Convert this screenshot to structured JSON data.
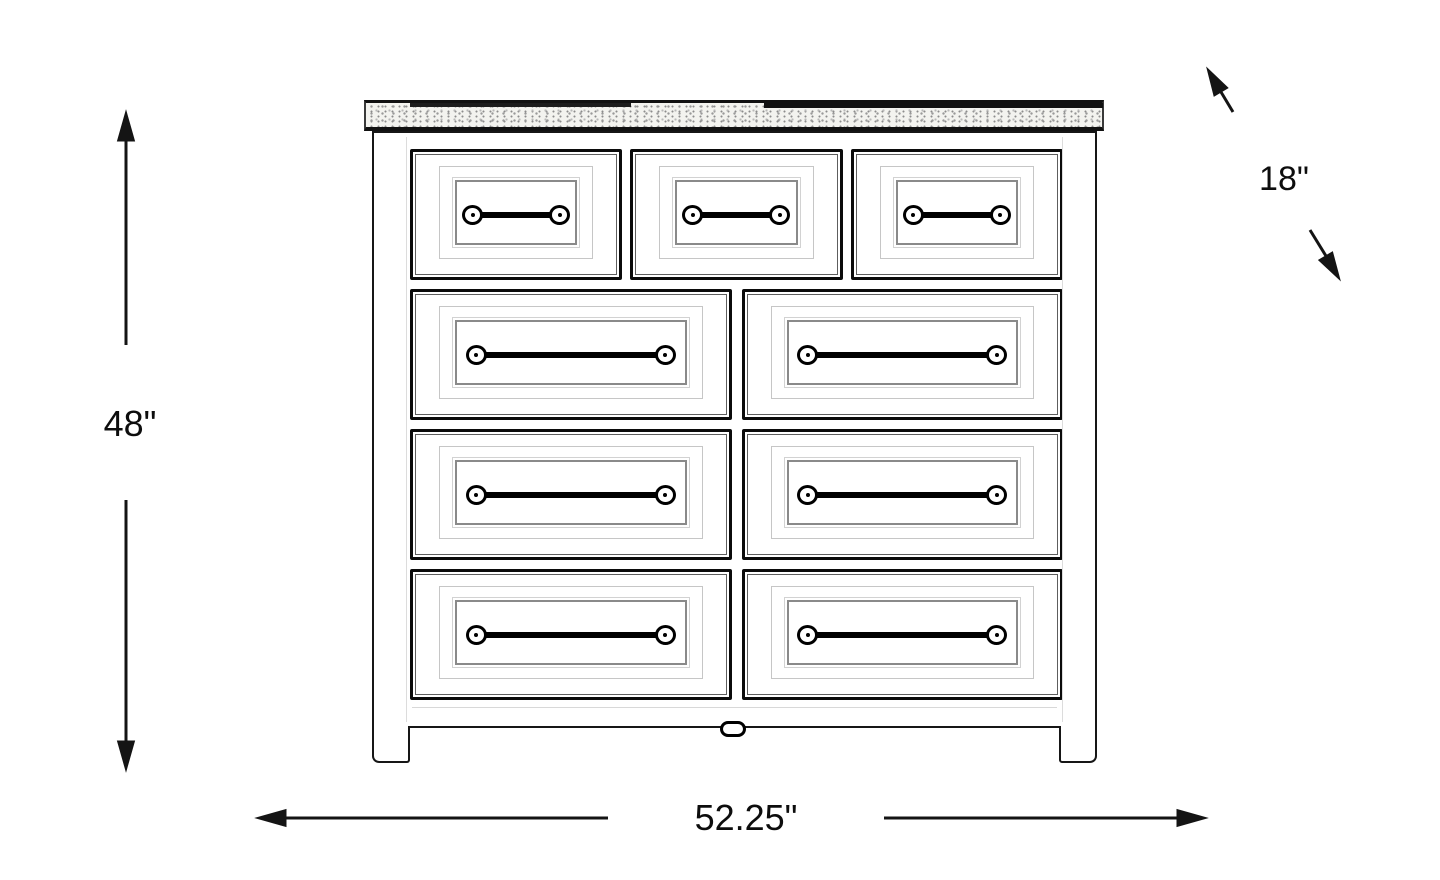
{
  "dimensions": {
    "height": "48\"",
    "depth": "18\"",
    "width": "52.25\""
  },
  "dresser": {
    "total_drawers": 9,
    "rows": [
      {
        "drawers": 3
      },
      {
        "drawers": 2
      },
      {
        "drawers": 2
      },
      {
        "drawers": 2
      }
    ]
  },
  "colors": {
    "line": "#141414",
    "background": "#ffffff"
  }
}
